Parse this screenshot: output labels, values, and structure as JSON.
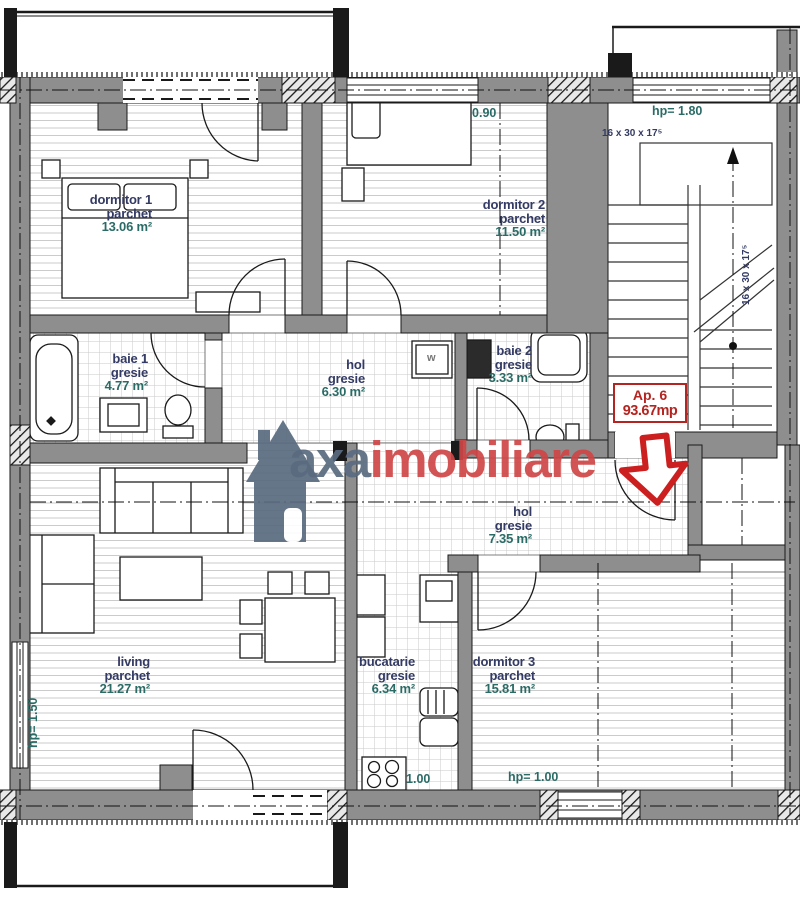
{
  "plan": {
    "rooms": [
      {
        "id": "dormitor1",
        "name": "dormitor 1",
        "material": "parchet",
        "area": "13.06 m²"
      },
      {
        "id": "dormitor2",
        "name": "dormitor 2",
        "material": "parchet",
        "area": "11.50 m²"
      },
      {
        "id": "baie1",
        "name": "baie 1",
        "material": "gresie",
        "area": "4.77 m²"
      },
      {
        "id": "hol1",
        "name": "hol",
        "material": "gresie",
        "area": "6.30 m²"
      },
      {
        "id": "baie2",
        "name": "baie 2",
        "material": "gresie",
        "area": "3.33 m²"
      },
      {
        "id": "hol2",
        "name": "hol",
        "material": "gresie",
        "area": "7.35 m²"
      },
      {
        "id": "living",
        "name": "living",
        "material": "parchet",
        "area": "21.27 m²"
      },
      {
        "id": "bucatarie",
        "name": "bucatarie",
        "material": "gresie",
        "area": "6.34 m²"
      },
      {
        "id": "dormitor3",
        "name": "dormitor 3",
        "material": "parchet",
        "area": "15.81 m²"
      }
    ],
    "annotations": {
      "hp_dormitor2": "hp= 0.90",
      "hp_stairs": "hp= 1.80",
      "hp_left": "hp= 1.50",
      "hp_dormitor3": "hp= 1.00",
      "hp_kitchen": "hp= 1.00",
      "stair_note": "16 x 30 x 17⁵",
      "washer_letter": "w"
    },
    "badge": {
      "line1": "Ap. 6",
      "line2": "93.67mp"
    },
    "watermark": {
      "part1": "axa",
      "part2": "imobiliare"
    },
    "colors": {
      "wall_gray": "#8e8e8e",
      "label_navy": "#333a63",
      "area_teal": "#2a6b66",
      "badge_red": "#b42420",
      "watermark_slate": "#5a6b80",
      "watermark_red": "#cf4646"
    }
  }
}
